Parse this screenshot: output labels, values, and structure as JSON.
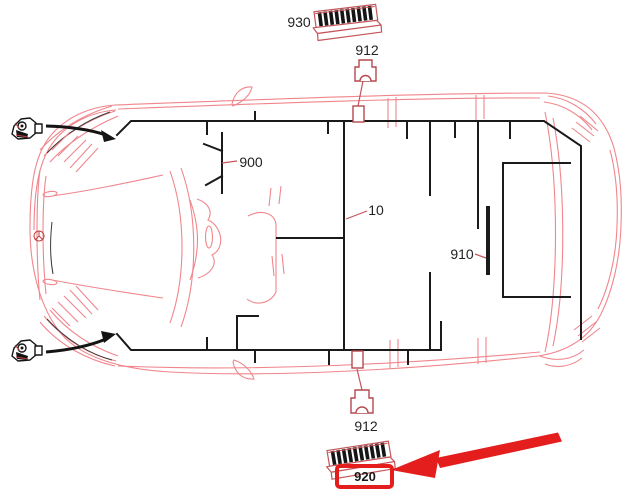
{
  "diagram": {
    "callouts": {
      "c930": "930",
      "c912_top": "912",
      "c900": "900",
      "c10": "10",
      "c910": "910",
      "c912_bottom": "912",
      "c920": "920"
    },
    "highlighted_part": "920",
    "colors": {
      "body_line": "#f0868c",
      "harness_line": "#1a1a1a",
      "leader_line": "#c4565a",
      "highlight_red": "#e41d1d",
      "label_text": "#232323"
    }
  }
}
